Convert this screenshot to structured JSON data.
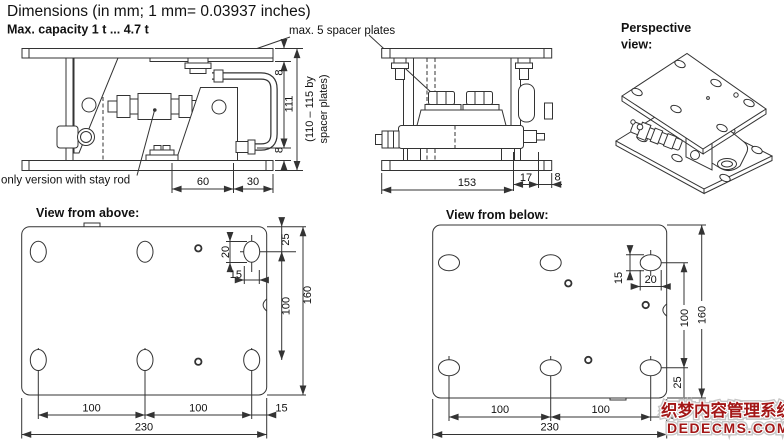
{
  "title": "Dimensions (in mm; 1 mm= 0.03937 inches)",
  "capacity": "Max. capacity 1 t ... 4.7 t",
  "annotations": {
    "spacer_plates": "max. 5 spacer plates",
    "stay_rod": "only version with stay rod"
  },
  "front_view": {
    "dim_spacer_top": "8",
    "dim_height": "111",
    "dim_spacer_bottom": "8",
    "dim_height_range_1": "(110 – 115 by",
    "dim_height_range_2": "spacer plates)",
    "dim_60": "60",
    "dim_30": "30"
  },
  "side_view": {
    "dim_153": "153",
    "dim_17": "17",
    "dim_8": "8"
  },
  "perspective_view": {
    "label_1": "Perspective",
    "label_2": "view:"
  },
  "top_view": {
    "label": "View from above:",
    "dim_edge_25": "25",
    "dim_slot_20": "20",
    "dim_slot_15": "15",
    "dim_pitch_100": "100",
    "dim_height_160": "160",
    "dim_100_left": "100",
    "dim_100_right": "100",
    "dim_15": "15",
    "dim_width_230": "230"
  },
  "bottom_view": {
    "label": "View from below:",
    "dim_slot_15": "15",
    "dim_slot_20": "20",
    "dim_pitch_100": "100",
    "dim_height_160": "160",
    "dim_edge_25": "25",
    "dim_100_left": "100",
    "dim_100_right": "100",
    "dim_15": "15",
    "dim_width_230": "230"
  },
  "watermark": {
    "line_1": "织梦内容管理系统",
    "line_2": "DEDECMS.COM",
    "color": "#9a1b1b"
  },
  "colors": {
    "line": "#333333",
    "text": "#111111",
    "background": "#ffffff"
  }
}
